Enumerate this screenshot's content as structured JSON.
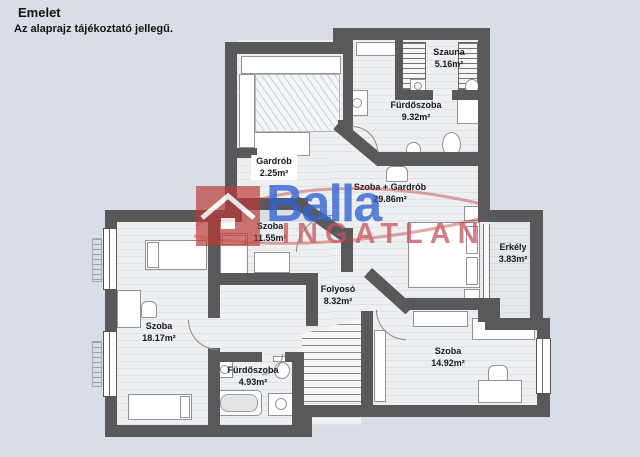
{
  "header": {
    "title": "Emelet",
    "subtitle": "Az alaprajz tájékoztató jellegű."
  },
  "watermark": {
    "brand": "Balla",
    "brand_sub": "INGATLAN",
    "brand_blue": "#2f63cf",
    "brand_red": "#bc3a34"
  },
  "colors": {
    "background": "#d8dde6",
    "wall": "#59595c",
    "floor": "#edeff1",
    "floor_line": "#e0e3e6"
  },
  "rooms": [
    {
      "id": "szauna",
      "name": "Szauna",
      "area": "5.16m²"
    },
    {
      "id": "furdoszoba-nagy",
      "name": "Fürdőszoba",
      "area": "9.32m²"
    },
    {
      "id": "gardrob",
      "name": "Gardrób",
      "area": "2.25m²"
    },
    {
      "id": "szoba-gardrob",
      "name": "Szoba + Gardrób",
      "area": "29.86m²"
    },
    {
      "id": "szoba-11",
      "name": "Szoba",
      "area": "11.55m²"
    },
    {
      "id": "erkely",
      "name": "Erkély",
      "area": "3.83m²"
    },
    {
      "id": "folyoso",
      "name": "Folyosó",
      "area": "8.32m²"
    },
    {
      "id": "szoba-18",
      "name": "Szoba",
      "area": "18.17m²"
    },
    {
      "id": "furdoszoba-kis",
      "name": "Fürdőszoba",
      "area": "4.93m²"
    },
    {
      "id": "szoba-14",
      "name": "Szoba",
      "area": "14.92m²"
    }
  ]
}
